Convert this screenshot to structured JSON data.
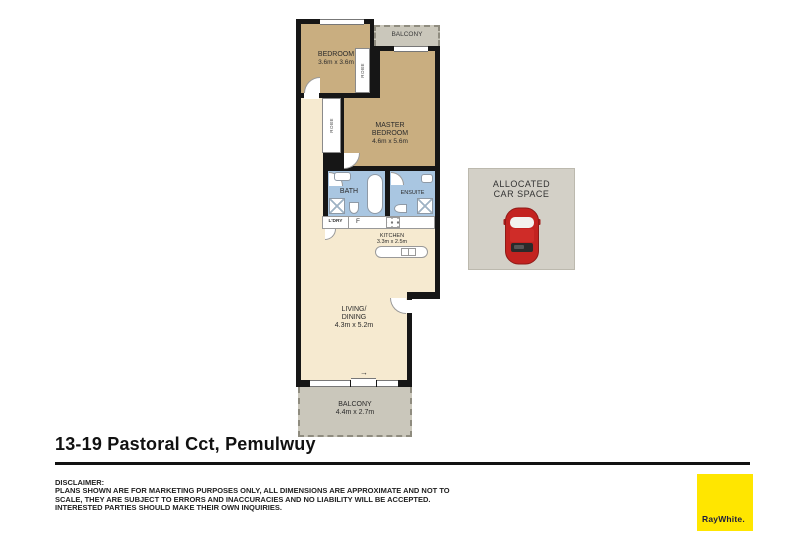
{
  "title": "13-19 Pastoral Cct, Pemulwuy",
  "floorplan": {
    "bedroom": {
      "label": "BEDROOM",
      "dims": "3.6m x 3.6m"
    },
    "master_bedroom": {
      "label_line1": "MASTER",
      "label_line2": "BEDROOM",
      "dims": "4.6m x 5.6m"
    },
    "balcony_top": {
      "label": "BALCONY"
    },
    "balcony_bottom": {
      "label": "BALCONY",
      "dims": "4.4m x 2.7m"
    },
    "bath": {
      "label": "BATH"
    },
    "ensuite": {
      "label": "ENSUITE"
    },
    "laundry": {
      "label": "L'DRY"
    },
    "fridge": {
      "label": "F"
    },
    "kitchen": {
      "label": "KITCHEN",
      "dims": "3.3m x 2.5m"
    },
    "living": {
      "label_line1": "LIVING/",
      "label_line2": "DINING",
      "dims": "4.3m x 5.2m"
    },
    "robe": {
      "label": "ROBE"
    },
    "sliding_door_arrow": "→"
  },
  "car_space": {
    "label_line1": "ALLOCATED",
    "label_line2": "CAR SPACE"
  },
  "disclaimer": {
    "heading": "DISCLAIMER:",
    "body": "PLANS SHOWN ARE FOR MARKETING PURPOSES ONLY, ALL DIMENSIONS ARE APPROXIMATE AND NOT TO SCALE, THEY ARE SUBJECT TO ERRORS AND INACCURACIES AND NO LIABILITY WILL BE ACCEPTED. INTERESTED PARTIES SHOULD MAKE THEIR OWN INQUIRIES."
  },
  "brand": {
    "name": "RayWhite."
  },
  "colors": {
    "wall": "#161616",
    "bedroom_fill": "#c9ae80",
    "living_fill": "#f6ead0",
    "wet_area_fill": "#a9c6e1",
    "balcony_fill": "#cac7bb",
    "car_space_fill": "#d3d0c7",
    "car_red": "#c32320",
    "brand_yellow": "#ffe600",
    "brand_navy": "#1d1c3d"
  }
}
